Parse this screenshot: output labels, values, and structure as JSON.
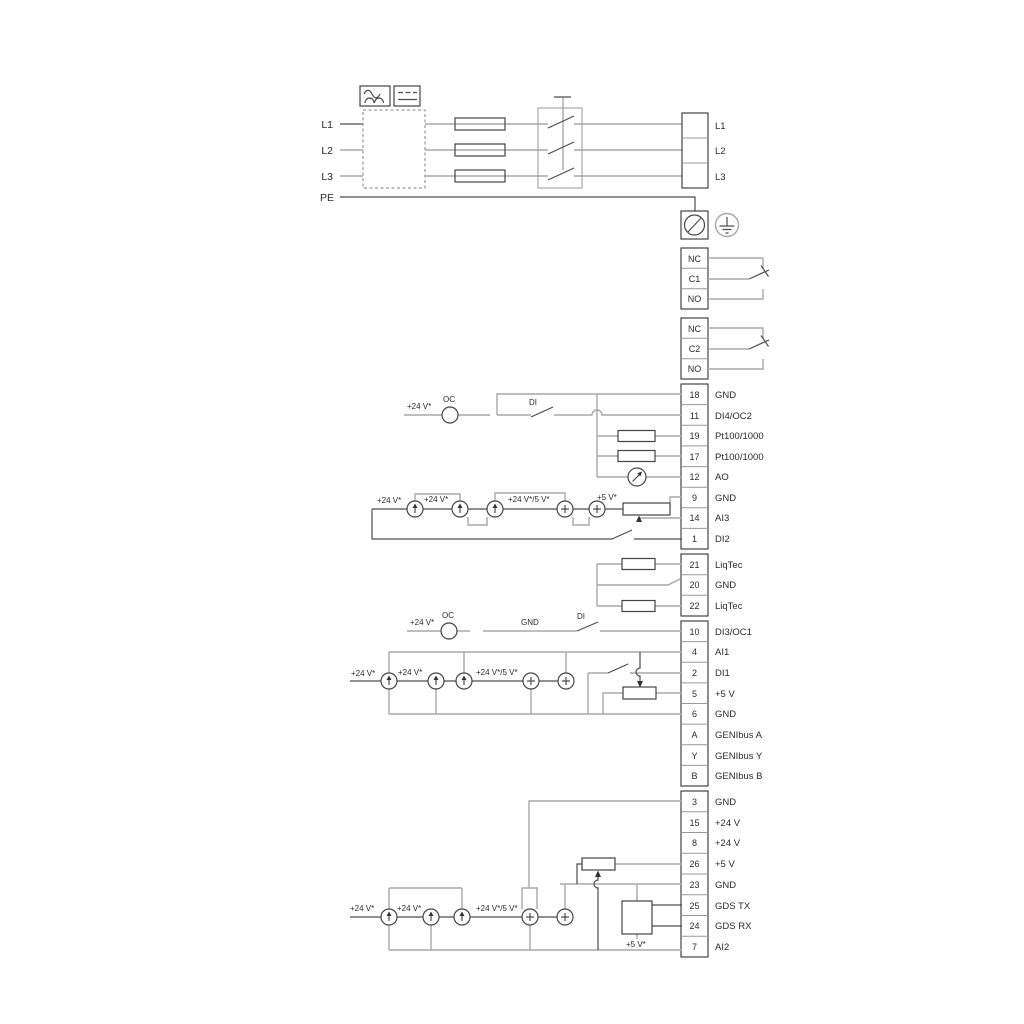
{
  "power": {
    "inputs": [
      "L1",
      "L2",
      "L3",
      "PE"
    ],
    "outputs": [
      "L1",
      "L2",
      "L3"
    ]
  },
  "relays": {
    "r1": [
      "NC",
      "C1",
      "NO"
    ],
    "r2": [
      "NC",
      "C2",
      "NO"
    ]
  },
  "groupA": [
    {
      "num": "18",
      "label": "GND"
    },
    {
      "num": "11",
      "label": "DI4/OC2"
    },
    {
      "num": "19",
      "label": "Pt100/1000"
    },
    {
      "num": "17",
      "label": "Pt100/1000"
    },
    {
      "num": "12",
      "label": "AO"
    },
    {
      "num": "9",
      "label": "GND"
    },
    {
      "num": "14",
      "label": "AI3"
    },
    {
      "num": "1",
      "label": "DI2"
    }
  ],
  "liqtec": [
    {
      "num": "21",
      "label": "LiqTec"
    },
    {
      "num": "20",
      "label": "GND"
    },
    {
      "num": "22",
      "label": "LiqTec"
    }
  ],
  "groupC": [
    {
      "num": "10",
      "label": "DI3/OC1"
    },
    {
      "num": "4",
      "label": "AI1"
    },
    {
      "num": "2",
      "label": "DI1"
    },
    {
      "num": "5",
      "label": "+5 V"
    },
    {
      "num": "6",
      "label": "GND"
    },
    {
      "num": "A",
      "label": "GENIbus A"
    },
    {
      "num": "Y",
      "label": "GENIbus Y"
    },
    {
      "num": "B",
      "label": "GENIbus B"
    }
  ],
  "groupD": [
    {
      "num": "3",
      "label": "GND"
    },
    {
      "num": "15",
      "label": "+24 V"
    },
    {
      "num": "8",
      "label": "+24 V"
    },
    {
      "num": "26",
      "label": "+5 V"
    },
    {
      "num": "23",
      "label": "GND"
    },
    {
      "num": "25",
      "label": "GDS TX"
    },
    {
      "num": "24",
      "label": "GDS RX"
    },
    {
      "num": "7",
      "label": "AI2"
    }
  ],
  "ann": {
    "supply24": "+24 V*",
    "mix": "+24 V*/5 V*",
    "v5": "+5 V*",
    "oc": "OC",
    "di": "DI",
    "gnd": "GND"
  }
}
